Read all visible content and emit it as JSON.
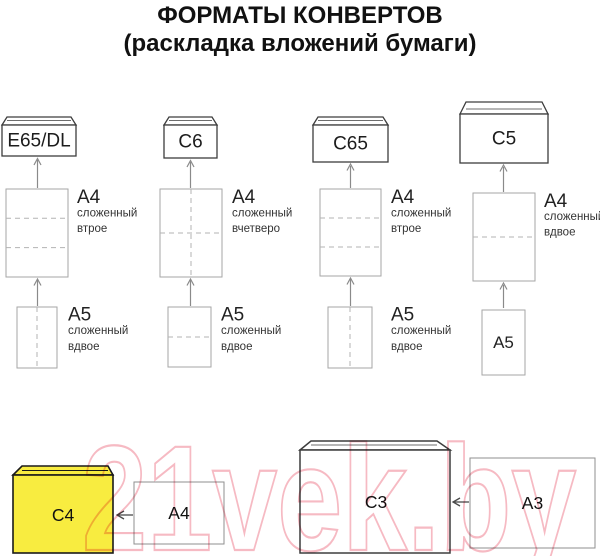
{
  "title": "ФОРМАТЫ КОНВЕРТОВ",
  "subtitle": "(раскладка вложений бумаги)",
  "watermark": {
    "text": "21vek.by"
  },
  "colors": {
    "envelope_yellow": "#f8ec40",
    "watermark_pink": "#f6bac3",
    "outline_dark": "#3d3d3d",
    "paper_border": "#a6a6a6"
  },
  "columns": [
    {
      "envelope": "E65/DL",
      "paper_top": {
        "name": "A4",
        "fold1": "сложенный",
        "fold2": "втрое"
      },
      "paper_bottom": {
        "name": "A5",
        "fold1": "сложенный",
        "fold2": "вдвое"
      }
    },
    {
      "envelope": "C6",
      "paper_top": {
        "name": "A4",
        "fold1": "сложенный",
        "fold2": "вчетверо"
      },
      "paper_bottom": {
        "name": "A5",
        "fold1": "сложенный",
        "fold2": "вдвое"
      }
    },
    {
      "envelope": "C65",
      "paper_top": {
        "name": "A4",
        "fold1": "сложенный",
        "fold2": "втрое"
      },
      "paper_bottom": {
        "name": "A5",
        "fold1": "сложенный",
        "fold2": "вдвое"
      }
    },
    {
      "envelope": "C5",
      "paper_top": {
        "name": "A4",
        "fold1": "сложенный",
        "fold2": "вдвое"
      },
      "paper_bottom": {
        "name": "A5"
      }
    }
  ],
  "bottom_row": {
    "envelope_c4": "C4",
    "paper_a4": "A4",
    "envelope_c3": "C3",
    "paper_a3": "A3"
  }
}
